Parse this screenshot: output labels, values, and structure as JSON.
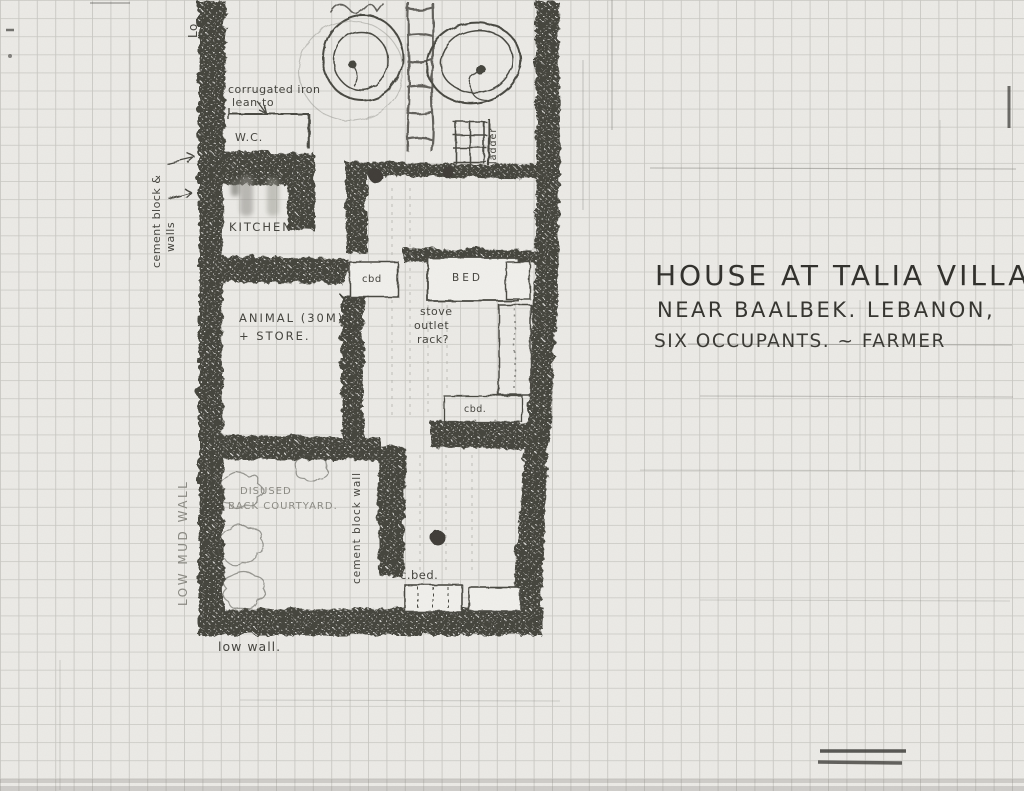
{
  "title_block": {
    "line1": "HOUSE AT TALIA VILLAGE",
    "line2": "NEAR BAALBEK. LEBANON,",
    "line3": "SIX OCCUPANTS. ~ FARMER"
  },
  "labels": {
    "lean_to_1": "corrugated iron",
    "lean_to_2": "lean-to",
    "wc": "W.C.",
    "kitchen": "KITCHEN",
    "cement_block_left_1": "cement block &",
    "cement_block_left_2": "walls",
    "animal_1": "ANIMAL (30M)",
    "animal_2": "+ STORE.",
    "cbd_upper": "cbd",
    "bed": "BED",
    "stove_1": "stove",
    "stove_2": "outlet",
    "stove_3": "rack?",
    "cbd_lower": "cbd.",
    "courtyard_1": "DISUSED",
    "courtyard_2": "BACK COURTYARD.",
    "low_mud_wall": "LOW MUD WALL",
    "cement_block_center": "cement block wall",
    "ladder": "ladder",
    "c_bed": "c.bed.",
    "low_wall": "low wall.",
    "edge_fragment": "Lo"
  },
  "colors": {
    "paper": "#ebeae6",
    "grid": "#c6c5c0",
    "grid_dark": "#7d7c77",
    "ink": "#45443e",
    "wall": "#45443e",
    "faint": "#8b8a83"
  }
}
